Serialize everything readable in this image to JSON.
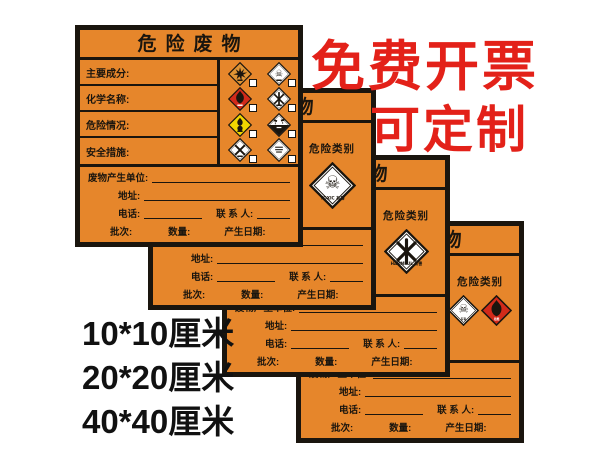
{
  "promo": {
    "line1": "免费开票",
    "line2": "可定制"
  },
  "sizes": {
    "option1": "10*10厘米",
    "option2": "20*20厘米",
    "option3": "40*40厘米"
  },
  "label": {
    "title": "危险废物",
    "fields": [
      "主要成分:",
      "化学名称:",
      "危险情况:",
      "安全措施:"
    ],
    "category_heading": "危险类别",
    "rows": {
      "unit": "废物产生单位:",
      "address": "地址:",
      "phone": "电话:",
      "contact": "联 系 人:",
      "batch": "批次:",
      "quantity": "数量:",
      "date": "产生日期:"
    },
    "grid_icons": [
      {
        "name": "explosive-icon",
        "glyph": "burst",
        "bg": "#e09434"
      },
      {
        "name": "toxic-icon",
        "glyph": "skull",
        "bg": "#ffffff"
      },
      {
        "name": "flammable-icon",
        "glyph": "flame",
        "bg": "#d22a1a"
      },
      {
        "name": "harmful-icon",
        "glyph": "cross6",
        "bg": "#ffffff"
      },
      {
        "name": "oxidizer-icon",
        "glyph": "oxidizer",
        "bg": "#f2d600"
      },
      {
        "name": "corrosive-icon",
        "glyph": "corrosive",
        "bg": "#ffffff"
      },
      {
        "name": "infectious-icon",
        "glyph": "crossx",
        "bg": "#ffffff"
      },
      {
        "name": "miscellaneous-icon",
        "glyph": "textlines",
        "bg": "#ffffff"
      }
    ],
    "back_variants": [
      {
        "icons": [
          {
            "name": "toxic-icon",
            "glyph": "skull",
            "bg": "#ffffff",
            "caption": "TOXIC 有毒"
          }
        ]
      },
      {
        "icons": [
          {
            "name": "harmful-icon",
            "glyph": "cross6",
            "bg": "#ffffff",
            "caption": "HARMFUL 有害"
          }
        ]
      },
      {
        "icons": [
          {
            "name": "toxic-icon",
            "glyph": "skull",
            "bg": "#ffffff",
            "caption": "有毒"
          },
          {
            "name": "flammable-icon",
            "glyph": "flame",
            "bg": "#d22a1a",
            "caption": "易燃"
          }
        ]
      }
    ]
  },
  "colors": {
    "label_bg": "#e6862b",
    "line": "#1a150e",
    "promo_red": "#e32119",
    "flammable_red": "#d22a1a",
    "oxidizer_yellow": "#f2d600",
    "explosive_orange": "#e09434"
  }
}
